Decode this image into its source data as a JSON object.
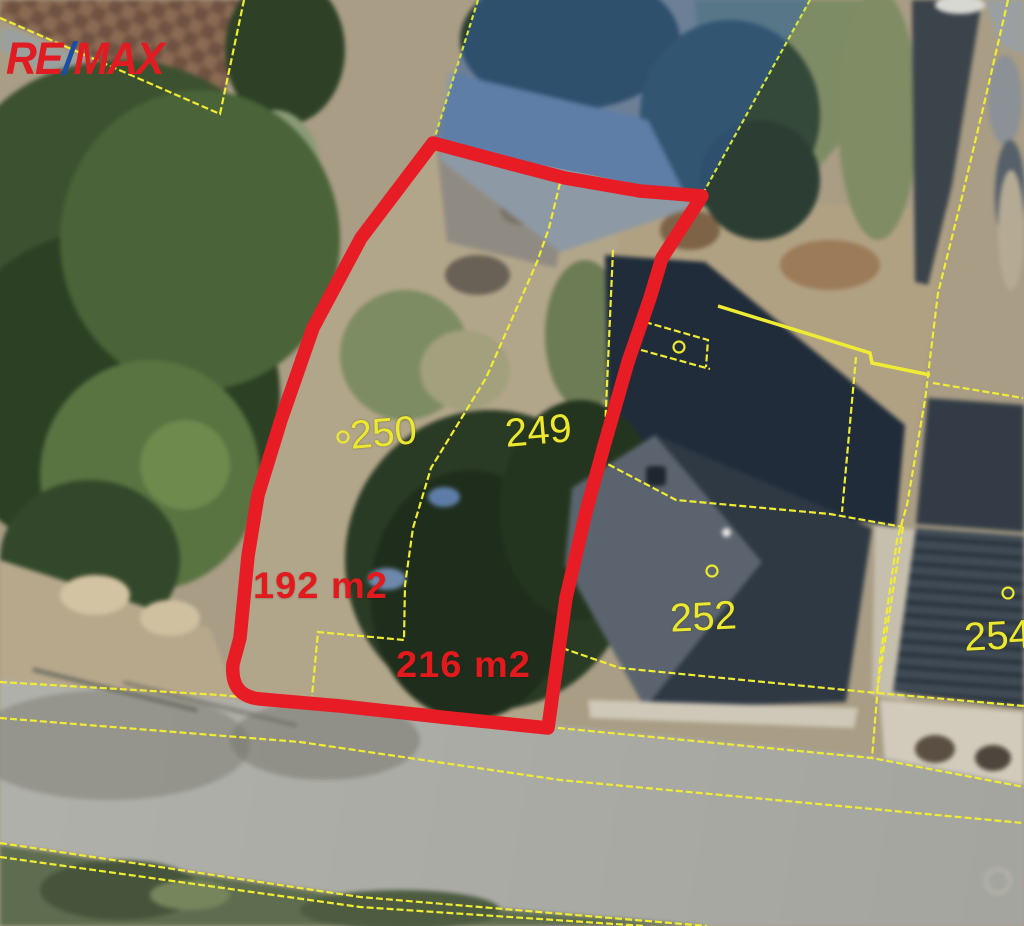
{
  "logo": {
    "re": "RE",
    "slash": "/",
    "max": "MAX"
  },
  "map": {
    "parcel_labels": {
      "p250": "250",
      "p249": "249",
      "p252": "252",
      "p254": "254"
    },
    "area_labels": {
      "a192": "192 m2",
      "a216": "216 m2"
    },
    "colors": {
      "highlight_outline": "#e81c24",
      "area_text": "#e21a1d",
      "cadastral_line": "#f0ec34",
      "parcel_text": "#ece72f",
      "selection_fill": "#2f61aa",
      "logo_red": "#e11b22",
      "logo_blue": "#1b4ea3"
    }
  }
}
